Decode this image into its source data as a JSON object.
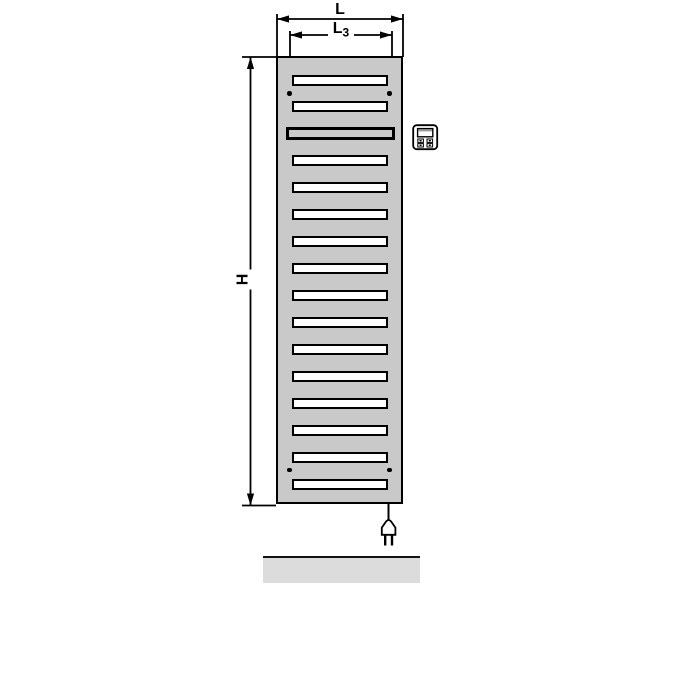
{
  "drawing": {
    "dimension_labels": {
      "overall_width": "L",
      "mounting_width_main": "L",
      "mounting_width_sub": "3",
      "overall_height": "H"
    },
    "radiator": {
      "slot_count": 16,
      "special_slot_index": 2,
      "mounting_dot_count": 4,
      "body_color": "#c9c9c9",
      "slot_fill": "#ffffff",
      "outline_color": "#000000"
    },
    "floor": {
      "fill": "#dcdcdc"
    },
    "icons": {
      "control_unit": "control-unit-icon",
      "power_plug": "power-plug-icon"
    }
  }
}
